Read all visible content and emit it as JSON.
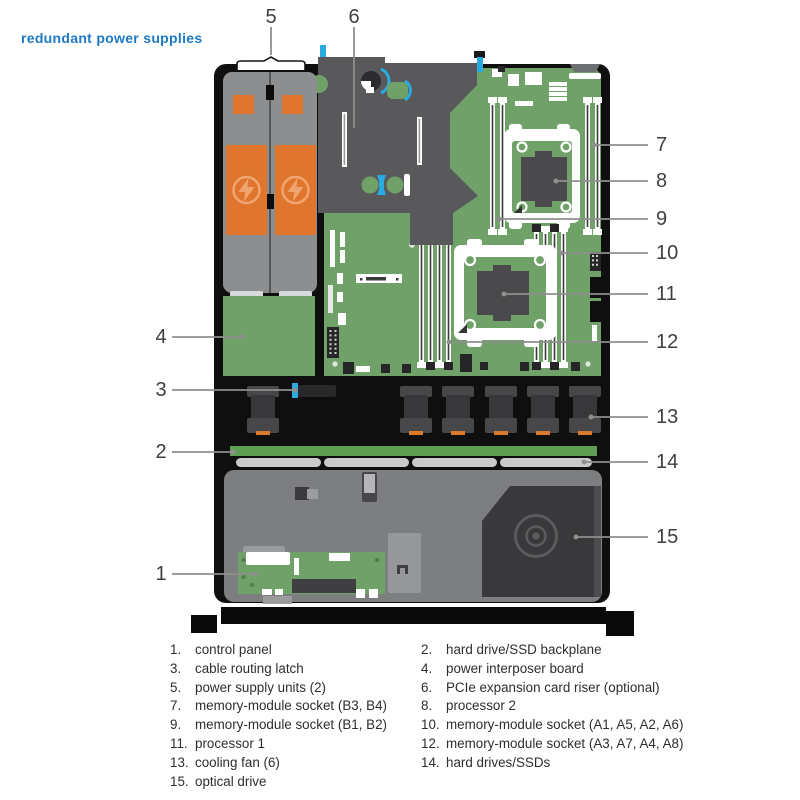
{
  "header": {
    "title": "redundant power supplies"
  },
  "diagram": {
    "description": "server interior top view with numbered callouts",
    "callouts": [
      {
        "num": "1"
      },
      {
        "num": "2"
      },
      {
        "num": "3"
      },
      {
        "num": "4"
      },
      {
        "num": "5"
      },
      {
        "num": "6"
      },
      {
        "num": "7"
      },
      {
        "num": "8"
      },
      {
        "num": "9"
      },
      {
        "num": "10"
      },
      {
        "num": "11"
      },
      {
        "num": "12"
      },
      {
        "num": "13"
      },
      {
        "num": "14"
      },
      {
        "num": "15"
      }
    ],
    "icons": {
      "psu_label": "lightning-bolt-icon",
      "optical": "optical-disc-icon"
    }
  },
  "legend": {
    "left": [
      {
        "num": "1.",
        "label": "control panel"
      },
      {
        "num": "3.",
        "label": "cable routing latch"
      },
      {
        "num": "5.",
        "label": "power supply units (2)"
      },
      {
        "num": "7.",
        "label": "memory-module socket (B3, B4)"
      },
      {
        "num": "9.",
        "label": "memory-module socket (B1, B2)"
      },
      {
        "num": "11.",
        "label": "processor 1"
      },
      {
        "num": "13.",
        "label": "cooling fan (6)"
      },
      {
        "num": "15.",
        "label": "optical drive"
      }
    ],
    "right": [
      {
        "num": "2.",
        "label": "hard drive/SSD backplane"
      },
      {
        "num": "4.",
        "label": "power interposer board"
      },
      {
        "num": "6.",
        "label": "PCIe expansion card riser (optional)"
      },
      {
        "num": "8.",
        "label": "processor 2"
      },
      {
        "num": "10.",
        "label": "memory-module socket (A1, A5, A2, A6)"
      },
      {
        "num": "12.",
        "label": "memory-module socket (A3, A7, A4, A8)"
      },
      {
        "num": "14.",
        "label": "hard drives/SSDs"
      }
    ]
  },
  "colors": {
    "title_blue": "#1e79c5",
    "accent_blue": "#29abe2",
    "board_green": "#6fa168",
    "backplane_green": "#5e9d52",
    "psu_orange": "#e0762e",
    "chassis_black": "#0f0f10",
    "riser_gray": "#59595b",
    "psu_gray": "#8d8e90",
    "front_gray": "#7d7e80",
    "drive_gray": "#c9cacb",
    "callout_line_gray": "#8f8f8f"
  }
}
